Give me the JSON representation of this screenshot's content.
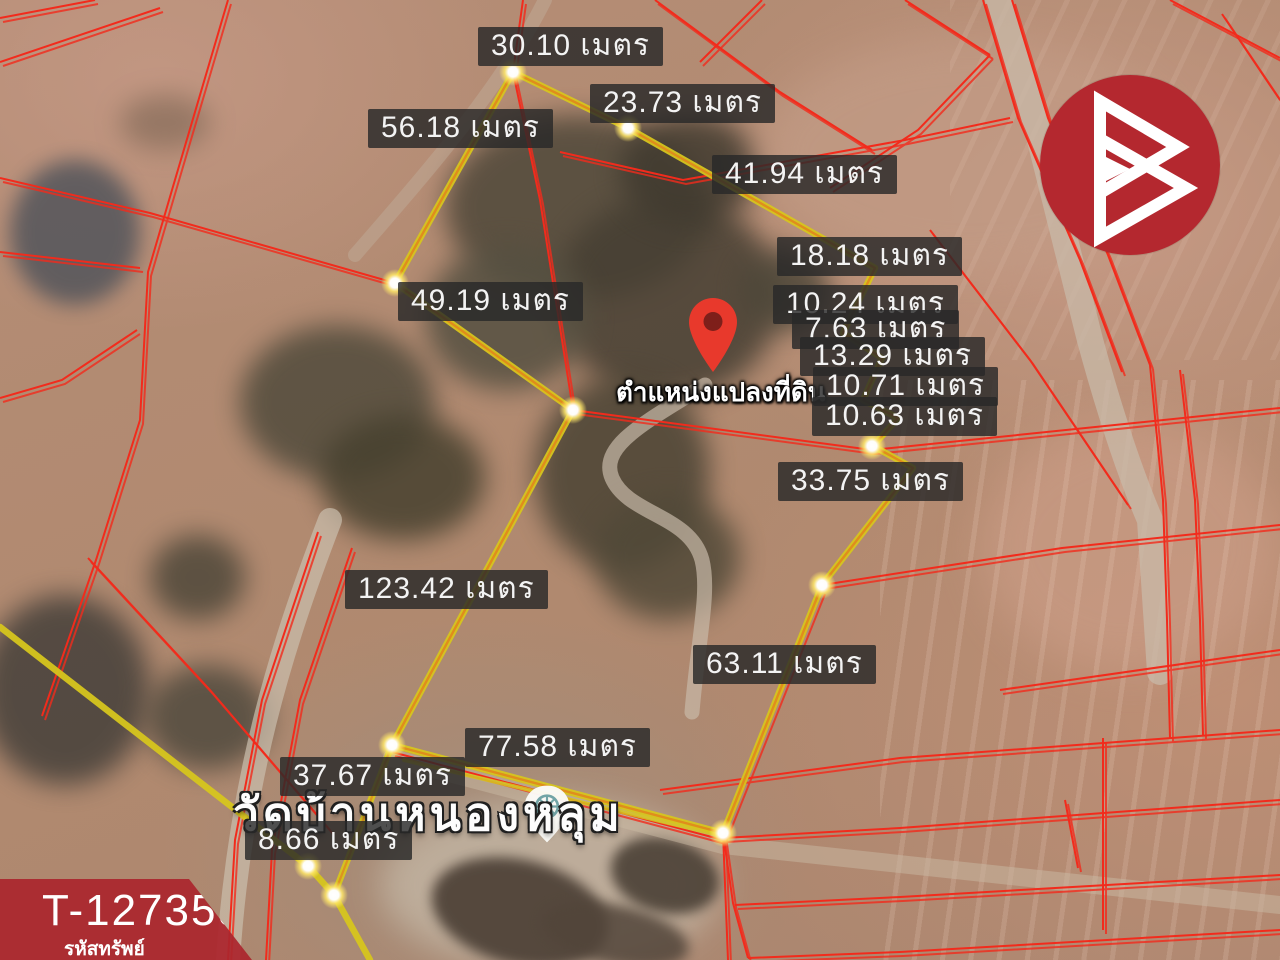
{
  "branding": {
    "logo_icon": "b-triangles-logo",
    "logo_color": "#b4282f"
  },
  "property_badge": {
    "code": "T-127359",
    "label": "รหัสทรัพย์"
  },
  "map": {
    "type": "satellite-photo",
    "pin_label": "ตำแหน่งแปลงที่ดิน",
    "place_name": "วัดบ้านหนองหลุม",
    "unit": "เมตร",
    "colors": {
      "boundary": "#d6c51e",
      "boundary_core": "#e2801c",
      "parcel_lines": "#f22b1c",
      "label_bg": "rgba(40,40,40,0.82)"
    },
    "measurements": [
      {
        "m": 30.1,
        "label": "30.10 เมตร",
        "x": 478,
        "y": 27
      },
      {
        "m": 23.73,
        "label": "23.73 เมตร",
        "x": 590,
        "y": 84
      },
      {
        "m": 56.18,
        "label": "56.18 เมตร",
        "x": 368,
        "y": 109
      },
      {
        "m": 41.94,
        "label": "41.94 เมตร",
        "x": 712,
        "y": 155
      },
      {
        "m": 18.18,
        "label": "18.18 เมตร",
        "x": 777,
        "y": 237
      },
      {
        "m": 10.24,
        "label": "10.24 เมตร",
        "x": 773,
        "y": 285
      },
      {
        "m": 7.63,
        "label": "7.63 เมตร",
        "x": 792,
        "y": 310
      },
      {
        "m": 13.29,
        "label": "13.29 เมตร",
        "x": 800,
        "y": 337
      },
      {
        "m": 10.71,
        "label": "10.71 เมตร",
        "x": 813,
        "y": 367
      },
      {
        "m": 10.63,
        "label": "10.63 เมตร",
        "x": 812,
        "y": 397
      },
      {
        "m": 49.19,
        "label": "49.19 เมตร",
        "x": 398,
        "y": 282
      },
      {
        "m": 33.75,
        "label": "33.75 เมตร",
        "x": 778,
        "y": 462
      },
      {
        "m": 123.42,
        "label": "123.42 เมตร",
        "x": 345,
        "y": 570
      },
      {
        "m": 63.11,
        "label": "63.11 เมตร",
        "x": 693,
        "y": 645
      },
      {
        "m": 77.58,
        "label": "77.58 เมตร",
        "x": 465,
        "y": 728
      },
      {
        "m": 37.67,
        "label": "37.67 เมตร",
        "x": 280,
        "y": 757
      },
      {
        "m": 8.66,
        "label": "8.66 เมตร",
        "x": 245,
        "y": 821
      }
    ],
    "vertices": [
      [
        513,
        72
      ],
      [
        628,
        128
      ],
      [
        395,
        283
      ],
      [
        573,
        410
      ],
      [
        872,
        446
      ],
      [
        822,
        585
      ],
      [
        723,
        833
      ],
      [
        392,
        745
      ],
      [
        308,
        866
      ],
      [
        334,
        895
      ]
    ]
  }
}
